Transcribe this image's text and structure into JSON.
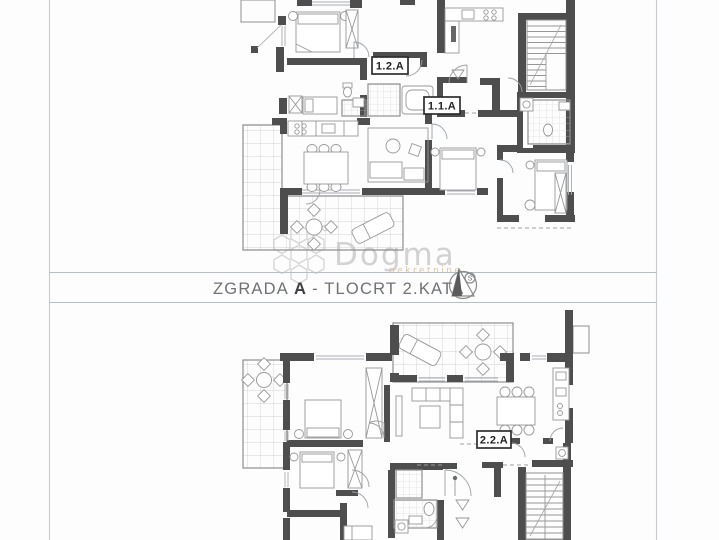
{
  "page": {
    "background": "#fdfdfd",
    "frame_color": "#c6cbd0"
  },
  "title_block": {
    "prefix": "ZGRADA",
    "building": "A",
    "suffix": "- TLOCRT 2.KATA",
    "full_text": "ZGRADA A - TLOCRT 2.KATA",
    "text_color": "#6f7174",
    "north_icon": "compass-north-icon",
    "north_letter": "S"
  },
  "watermark": {
    "brand": "Dogma",
    "tagline": "nekretnine",
    "logo_icon": "hex-flower-logo",
    "brand_color": "#c8c8c8",
    "tagline_color": "#d9bfa4"
  },
  "plans": {
    "colors": {
      "wall": "#4e4e4e",
      "line": "#8f8f8f",
      "grid": "#c6c6c6"
    },
    "upper": {
      "unit_labels": [
        {
          "id": "1.2.A"
        },
        {
          "id": "1.1.A"
        }
      ]
    },
    "lower": {
      "unit_labels": [
        {
          "id": "2.2.A"
        }
      ]
    }
  }
}
